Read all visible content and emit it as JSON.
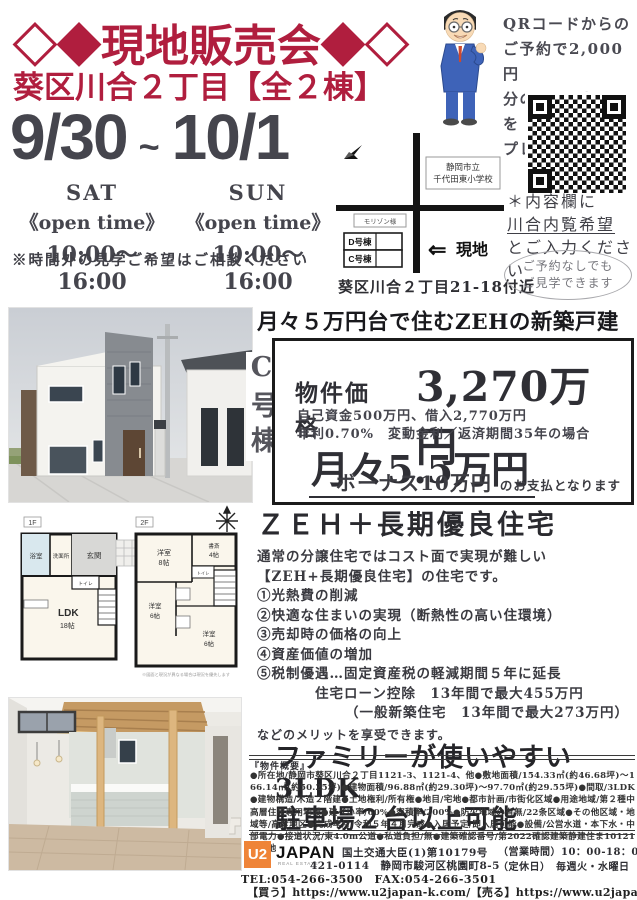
{
  "colors": {
    "accent": "#b01e3e",
    "dark_text": "#45454d",
    "logo_orange": "#ef8438"
  },
  "header": {
    "title": "◇◆現地販売会◆◇",
    "subtitle": "葵区川合２丁目【全２棟】"
  },
  "event": {
    "date_start": "9/30",
    "date_tilde": "~",
    "date_end": "10/1",
    "days": [
      {
        "day": "SAT",
        "open_label": "《open time》",
        "hours": "10:00～16:00"
      },
      {
        "day": "SUN",
        "open_label": "《open time》",
        "hours": "10:00～16:00"
      }
    ],
    "note": "※時間外の見学ご希望はご相談ください"
  },
  "qr_promo": {
    "line1": "QRコードからの",
    "line2": "ご予約で2,000円",
    "line3": "分のQUOカードを",
    "line4": "プレゼント！！"
  },
  "map": {
    "school_line1": "静岡市立",
    "school_line2": "千代田東小学校",
    "landmark": "モリゾン様",
    "bldg_d": "D号棟",
    "bldg_c": "C号棟",
    "arrow": "⇐",
    "site_label": "現地",
    "caption": "葵区川合２丁目21-18付近"
  },
  "reserve": {
    "line1": "＊内容欄に",
    "line2": "川合内覧希望",
    "line3": "とご入力ください",
    "badge_line1": "ご予約なしでも",
    "badge_line2": "ご見学できます"
  },
  "offer": {
    "headline": "月々５万円台で住むZEHの新築戸建",
    "unit": "C号棟",
    "price_label": "物件価格",
    "price": "3,270万円",
    "detail1": "自己資金500万円、借入2,770万円",
    "detail2": "年利0.70%　変動金利／返済期間35年の場合",
    "monthly": "月々5.5万円",
    "bonus": "ボーナス10万円",
    "bonus_suffix": "のお支払となります"
  },
  "zeh": {
    "title": "ＺＥＨ＋長期優良住宅",
    "intro1": "通常の分譲住宅ではコスト面で実現が難しい",
    "intro2": "【ZEH+長期優良住宅】の住宅です。",
    "item1": "①光熱費の削減",
    "item2": "②快適な住まいの実現（断熱性の高い住環境）",
    "item3": "③売却時の価格の向上",
    "item4": "④資産価値の増加",
    "item5": "⑤税制優遇…固定資産税の軽減期間５年に延長",
    "sub1": "住宅ローン控除　13年間で最大455万円",
    "sub2": "（一般新築住宅　13年間で最大273万円）",
    "outro": "などのメリットを享受できます。",
    "big1": "ファミリーが使いやすい3LDK",
    "big2": "駐車場２台以上可能"
  },
  "floorplan": {
    "f1": "1F",
    "f2": "2F",
    "rooms": {
      "bath": "浴室",
      "wash": "洗面所",
      "genkan": "玄関",
      "toilet": "トイレ",
      "ldk": "LDK",
      "ldk_size": "18帖",
      "yo": "洋室",
      "size8": "8帖",
      "size6": "6帖",
      "study": "書斎",
      "size4": "4帖",
      "note": "※図面と現況が異なる場合は現況を優先します"
    }
  },
  "spec": {
    "title": "『物件概要』",
    "body": "●所在地/静岡市葵区川合２丁目1121-3、1121-4、他●敷地面積/154.33㎡(約46.68坪)～166.14㎡(約50.25坪)●建物面積/96.88㎡(約29.30坪)～97.70㎡(約29.55坪)●間取/3LDK●建物構造/木造２階建●土地権利/所有権●地目/宅地●都市計画/市街化区域●用途地域/第２種中高層住居専用地域●建ぺい率/60%●容積率/200%●防火地域の有無/22条区域●その他区域・地域等/高度地区●完成年月/令和５年４月完成●入居予定/即入居可能●設備/公営水道・本下水・中部電力●接道状況/東4.0m公道●私道負担/無●建築確認番号/第2022確認建築静建住ま10121号、他"
  },
  "footer": {
    "logo_u2": "U2",
    "logo_japan": "JAPAN",
    "logo_sub": "REAL ESTATE",
    "license": "国土交通大臣(1)第10179号",
    "address": "421-0114　静岡市駿河区桃園町8-5",
    "hours_line": "（営業時間）10：00-18：00",
    "closed_line": "（定休日）　毎週火・水曜日",
    "tel": "TEL:054-266-3500　FAX:054-266-3501",
    "buy_label": "【買う】",
    "buy_url": "https://www.u2japan-k.com/",
    "sell_label": "【売る】",
    "sell_url": "https://www.u2japan-u.com/"
  }
}
